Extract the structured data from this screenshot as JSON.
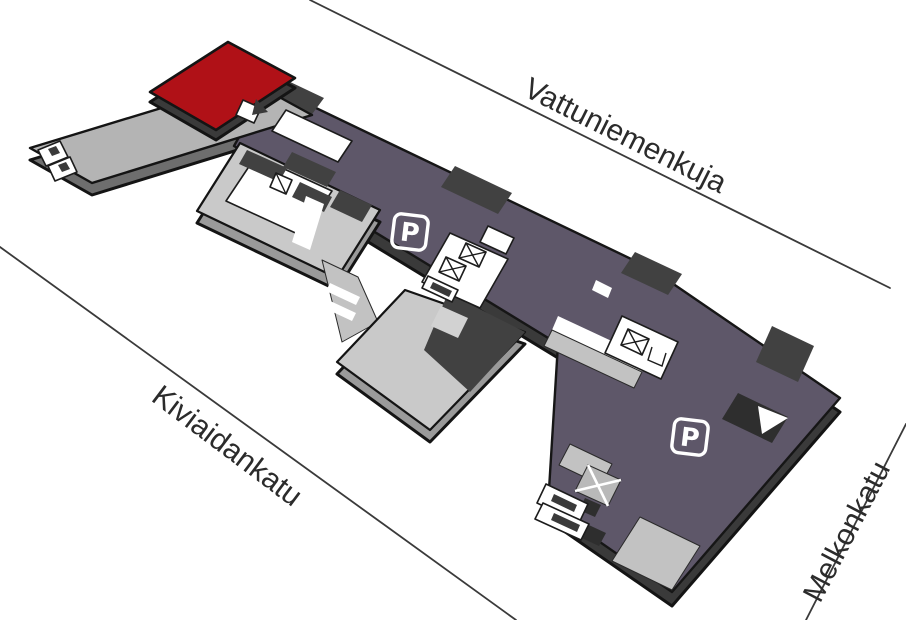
{
  "streets": {
    "top": {
      "name": "Vattuniemenkuja"
    },
    "bottom_left": {
      "name": "Kiviaidankatu"
    },
    "right": {
      "name": "Melkonkatu"
    }
  },
  "parking": {
    "symbol_left": {
      "label": "P"
    },
    "symbol_right": {
      "label": "P"
    }
  },
  "colors": {
    "parking_deck_purple": "#5e5769",
    "roof_red": "#b01117",
    "slab_light_gray": "#c9c9c9",
    "slab_mid_gray": "#b4b4b4",
    "block_dark_gray": "#414141",
    "outline_black": "#141414",
    "street_line": "#3a3a3a",
    "street_text": "#2b2b2b",
    "background": "#ffffff"
  }
}
